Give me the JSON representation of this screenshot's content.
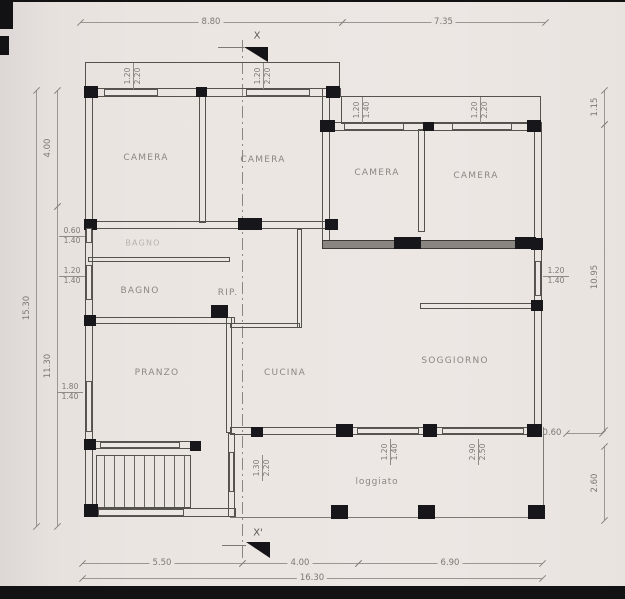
{
  "document": {
    "kind": "architectural floor plan (scanned drawing)"
  },
  "colors": {
    "paper": "#eae4e1",
    "line": "#8f8b87",
    "wall": "#54504c",
    "ink": "#141318",
    "text": "#827e7a"
  },
  "rooms": [
    {
      "name": "camera-1",
      "label": "CAMERA"
    },
    {
      "name": "camera-2",
      "label": "CAMERA"
    },
    {
      "name": "camera-3",
      "label": "CAMERA"
    },
    {
      "name": "camera-4",
      "label": "CAMERA"
    },
    {
      "name": "bagno-2",
      "label": "BAGNO"
    },
    {
      "name": "bagno",
      "label": "BAGNO"
    },
    {
      "name": "rip",
      "label": "RIP."
    },
    {
      "name": "pranzo",
      "label": "PRANZO"
    },
    {
      "name": "cucina",
      "label": "CUCINA"
    },
    {
      "name": "soggiorno",
      "label": "SOGGIORNO"
    },
    {
      "name": "loggiato",
      "label": "loggiato"
    }
  ],
  "dimensions": [
    {
      "name": "dim-top-8p80",
      "label": "8.80"
    },
    {
      "name": "dim-top-7p35",
      "label": "7.35"
    },
    {
      "name": "dim-left-15p30",
      "label": "15.30"
    },
    {
      "name": "dim-left-4p00",
      "label": "4.00"
    },
    {
      "name": "dim-left-11p30",
      "label": "11.30"
    },
    {
      "name": "dim-right-1p15",
      "label": "1.15"
    },
    {
      "name": "dim-right-10p95",
      "label": "10.95"
    },
    {
      "name": "dim-right-0p60",
      "label": "0.60"
    },
    {
      "name": "dim-right-2p60",
      "label": "2.60"
    },
    {
      "name": "dim-bot-5p50",
      "label": "5.50"
    },
    {
      "name": "dim-bot-4p00",
      "label": "4.00"
    },
    {
      "name": "dim-bot-6p90",
      "label": "6.90"
    },
    {
      "name": "dim-bot-16p30",
      "label": "16.30"
    }
  ],
  "openings": [
    {
      "name": "op-top-a",
      "w": "1.20",
      "h": "2.20"
    },
    {
      "name": "op-top-b",
      "w": "1.20",
      "h": "2.20"
    },
    {
      "name": "op-top-c",
      "w": "1.20",
      "h": "1.40"
    },
    {
      "name": "op-top-d",
      "w": "1.20",
      "h": "2.20"
    },
    {
      "name": "op-left-a",
      "w": "0.60",
      "h": "1.40"
    },
    {
      "name": "op-left-b",
      "w": "1.20",
      "h": "1.40"
    },
    {
      "name": "op-left-c",
      "w": "1.80",
      "h": "1.40"
    },
    {
      "name": "op-right-a",
      "w": "1.20",
      "h": "1.40"
    },
    {
      "name": "op-bot-a",
      "w": "1.30",
      "h": "2.20"
    },
    {
      "name": "op-bot-b",
      "w": "1.20",
      "h": "1.40"
    },
    {
      "name": "op-bot-c",
      "w": "2.90",
      "h": "2.50"
    }
  ],
  "section": {
    "top": "X",
    "bottom": "X'"
  }
}
